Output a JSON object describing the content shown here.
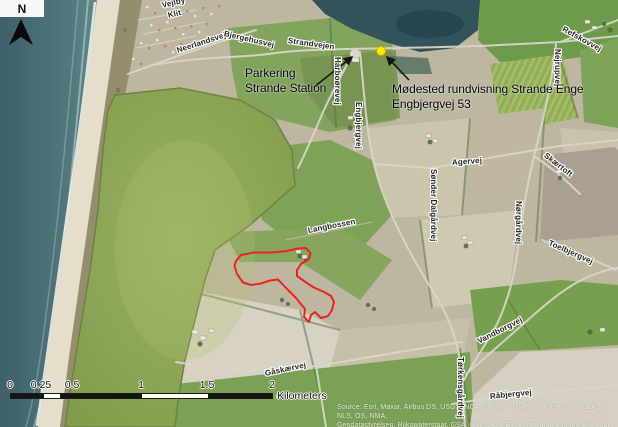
{
  "map": {
    "north_indicator": {
      "label": "N"
    },
    "annotations": {
      "parkering": {
        "line1": "Parkering",
        "line2": "Strande Station"
      },
      "meeting_point": {
        "line1": "Mødested rundvisning Strande Enge",
        "line2": "Engbjergvej 53"
      }
    },
    "marker": {
      "color": "#ffe800"
    },
    "highlight_area": {
      "outline_color": "#e8251c"
    },
    "road_labels": [
      {
        "id": "vejlby",
        "text": "Vejlby"
      },
      {
        "id": "klit",
        "text": "Klit"
      },
      {
        "id": "neerlandsvej",
        "text": "Neerlandsvej"
      },
      {
        "id": "bjergehusvej",
        "text": "Bjergehusvej"
      },
      {
        "id": "strandvejen",
        "text": "Strandvejen"
      },
      {
        "id": "harboorevej",
        "text": "Harboørevej"
      },
      {
        "id": "engbjergvej",
        "text": "Engbjergvej"
      },
      {
        "id": "agervej",
        "text": "Agervej"
      },
      {
        "id": "sonder-dalgardvej",
        "text": "Sønder Dalgårdvej"
      },
      {
        "id": "skaertoft",
        "text": "Skærtoft"
      },
      {
        "id": "nejrupvej",
        "text": "Nejrupvej"
      },
      {
        "id": "refskovvej",
        "text": "Refskovvej"
      },
      {
        "id": "norgardvej",
        "text": "Nørgårdvej"
      },
      {
        "id": "toelbjergvej",
        "text": "Toelbjergvej"
      },
      {
        "id": "vandborgvej",
        "text": "Vandborgvej"
      },
      {
        "id": "langbossen",
        "text": "Langbossen"
      },
      {
        "id": "gaskaervej",
        "text": "Gåskærvej"
      },
      {
        "id": "torkensgardvej",
        "text": "Tørkensgårdvej"
      },
      {
        "id": "rabjergvej",
        "text": "Råbjergvej"
      }
    ],
    "scale_bar": {
      "ticks": [
        "0",
        "0.25",
        "0.5",
        "1",
        "1.5",
        "2"
      ],
      "unit": "Kilometers"
    },
    "attribution": {
      "line1": "Source: Esri, Maxar, Airbus DS, USGS, NGA, NASA, CGIAR, N Robinson, NCEAS, NLS, OS, NMA,",
      "line2": "Geodatastyrelsen, Rijkswaterstaat, GSA, Geoland, FEMA, Intermap and the GIS user community"
    }
  }
}
